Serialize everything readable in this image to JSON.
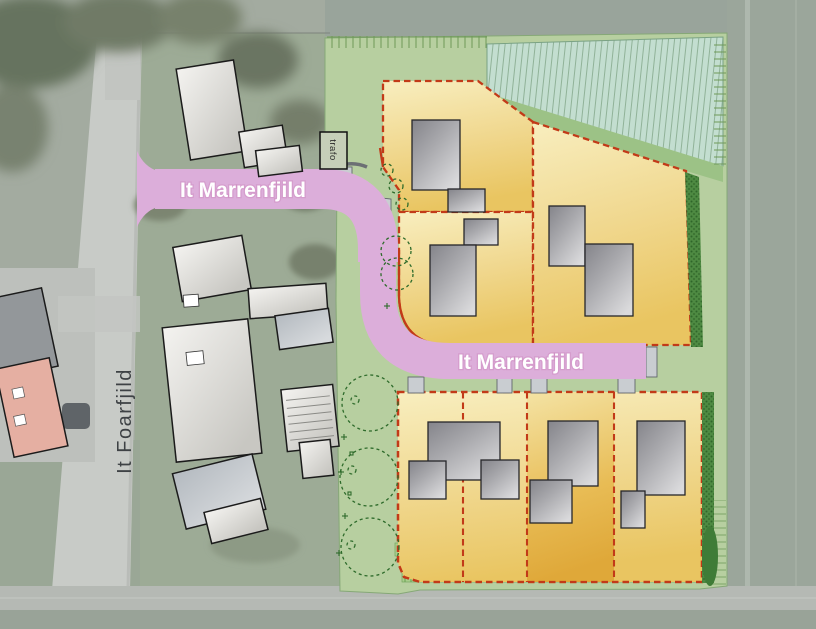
{
  "plan": {
    "streets": {
      "main_upper": "It Marrenfjild",
      "main_lower": "It Marrenfjild",
      "side": "It Foarfjild"
    },
    "utility": {
      "trafo": "trafo"
    },
    "legend_colors": {
      "aerial_field": "#a3aba0",
      "plan_green": "#b7cfa0",
      "pond_teal": "#c3ded0",
      "band_green": "#9cc286",
      "parcel_yellow_light": "#f8eebf",
      "parcel_yellow_deep": "#e9c561",
      "parcel_orange_deep": "#dfa839",
      "parcel_border_red": "#c23a18",
      "road_pink": "#dcaeda",
      "hedge_green": "#4e8a42",
      "driveway_gray": "#c9cdd1",
      "new_building_gray": "#a9a9ad"
    }
  }
}
